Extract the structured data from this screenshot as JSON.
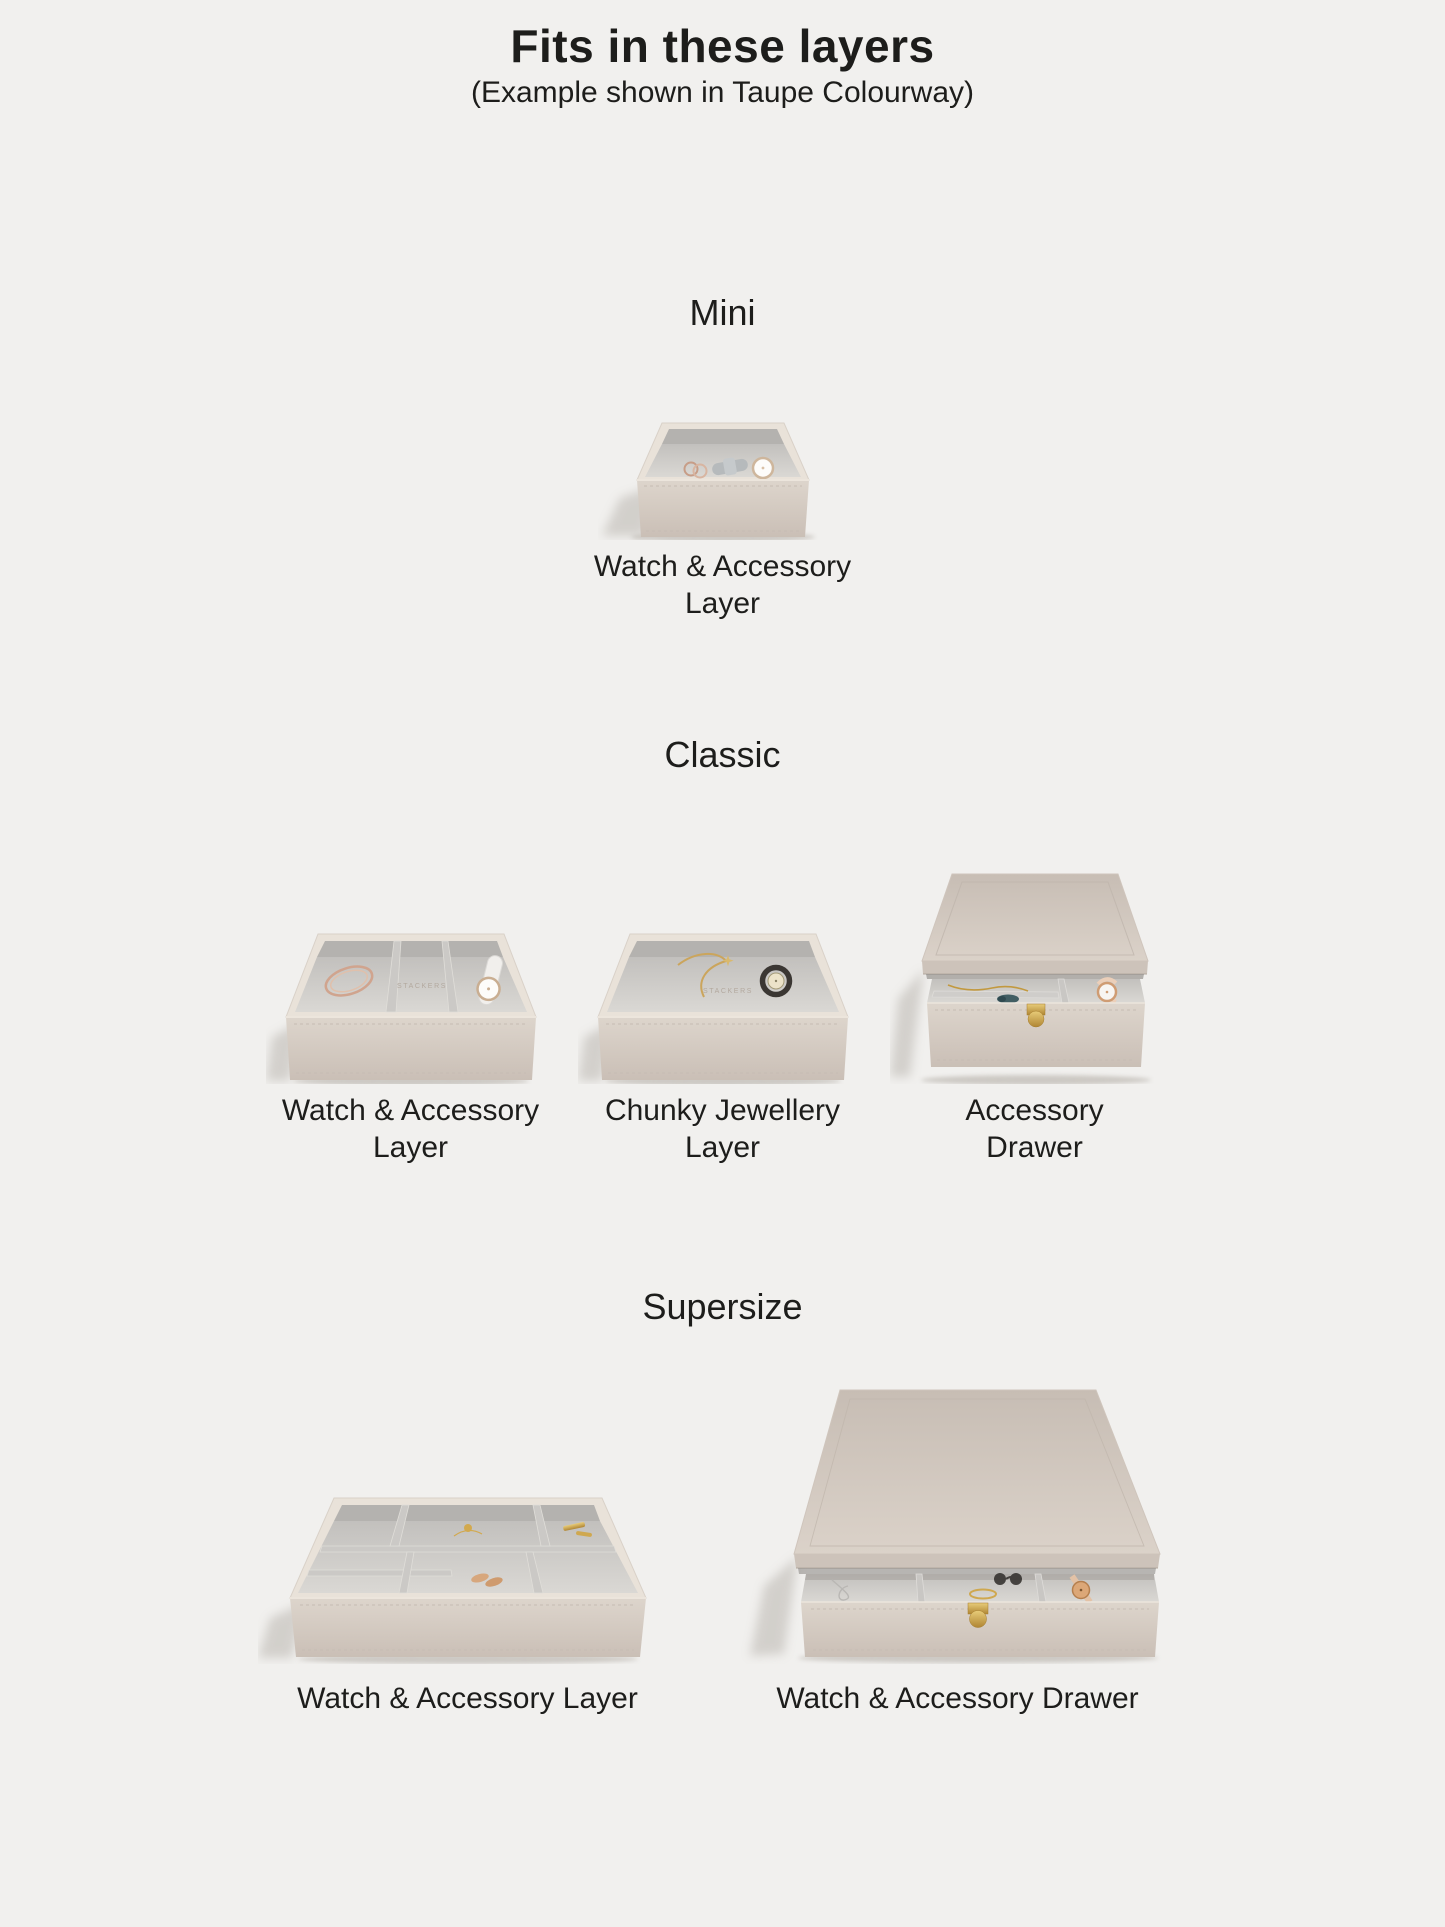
{
  "page": {
    "background": "#f1f0ee",
    "text_color": "#1d1d1b"
  },
  "header": {
    "title": "Fits in these layers",
    "subtitle": "(Example shown in Taupe Colourway)"
  },
  "colors": {
    "taupe_exterior": "#d5ccc3",
    "cream_rim": "#e9e2d9",
    "velvet_grey": "#c7c5c2",
    "gold_clasp": "#c9a149",
    "background": "#f1f0ee"
  },
  "sections": [
    {
      "id": "mini",
      "name": "Mini",
      "products": [
        {
          "label": "Watch & Accessory Layer",
          "type": "open-layer"
        }
      ]
    },
    {
      "id": "classic",
      "name": "Classic",
      "products": [
        {
          "label": "Watch & Accessory Layer",
          "type": "open-layer",
          "embossed_text": "STACKERS"
        },
        {
          "label": "Chunky Jewellery Layer",
          "type": "open-layer",
          "embossed_text": "STACKERS"
        },
        {
          "label": "Accessory Drawer",
          "type": "drawer"
        }
      ]
    },
    {
      "id": "supersize",
      "name": "Supersize",
      "products": [
        {
          "label": "Watch & Accessory Layer",
          "type": "open-layer"
        },
        {
          "label": "Watch & Accessory Drawer",
          "type": "drawer"
        }
      ]
    }
  ]
}
